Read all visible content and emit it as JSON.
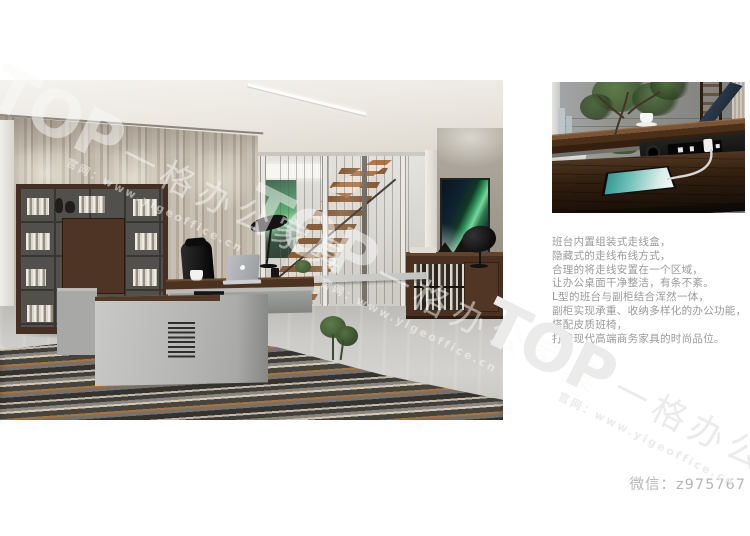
{
  "description": {
    "lines": [
      "班台内置组装式走线盒，",
      "隐藏式的走线布线方式，",
      "合理的将走线安置在一个区域，",
      "让办公桌面干净整洁，有条不紊。",
      "L型的班台与副柜结合浑然一体，",
      "副柜实现承重、收纳多样化的办公功能，",
      "搭配皮质班椅，",
      "打造现代高端商务家具的时尚品位。"
    ]
  },
  "contact": {
    "wechat": "微信：z975767"
  },
  "watermark": {
    "brand": "TOP",
    "brand_cn": "一格办公家具",
    "site": "官网：www.yigeoffice.cn"
  },
  "colors": {
    "walnut": "#4a3020",
    "desk_gray": "#b5b6b4",
    "aurora_green": "#35a065",
    "carpet_orange": "#ab7338",
    "body_text": "#9a9a9a",
    "watermark_gray": "#ebebeb",
    "wechat_text": "#b6b6b6"
  }
}
